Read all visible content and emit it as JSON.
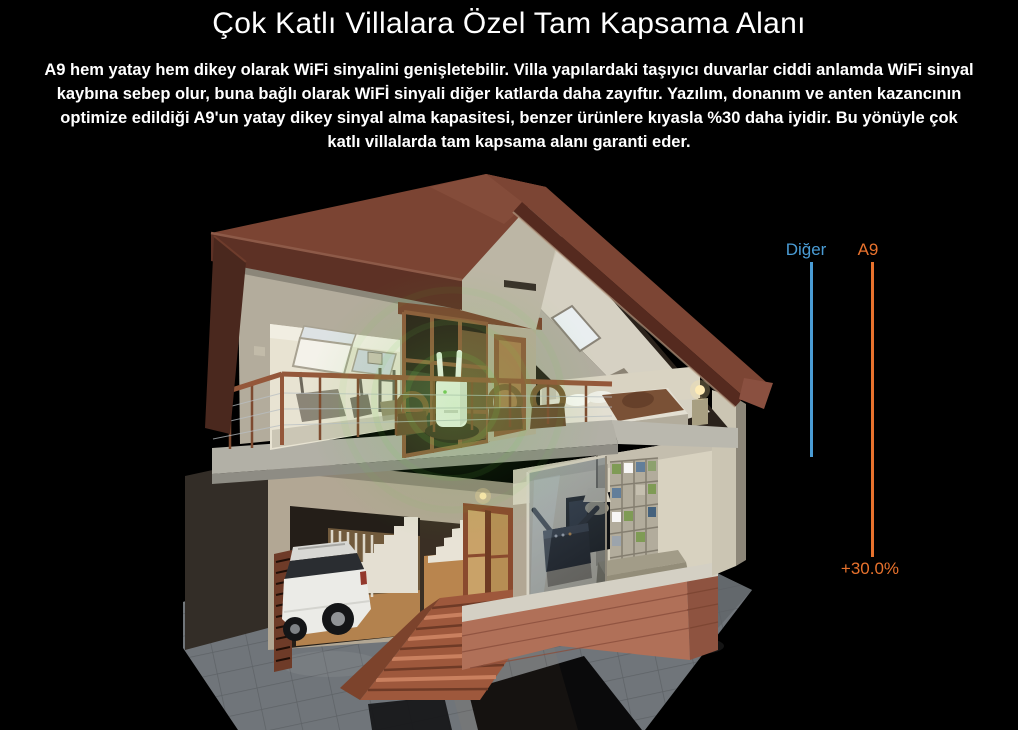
{
  "page": {
    "background_color": "#000000",
    "text_color": "#ffffff",
    "title": "Çok Katlı Villalara Özel Tam Kapsama Alanı",
    "description": "A9 hem yatay hem dikey olarak WiFi sinyalini genişletebilir. Villa yapılardaki taşıyıcı duvarlar ciddi anlamda WiFi sinyal kaybına sebep olur, buna bağlı olarak WiFİ sinyali diğer katlarda daha zayıftır. Yazılım, donanım ve anten kazancının optimize edildiği A9'un yatay dikey sinyal alma kapasitesi, benzer ürünlere kıyasla %30 daha iyidir. Bu yönüyle çok katlı villalarda tam kapsama alanı garanti eder."
  },
  "illustration": {
    "name": "villa-cutaway-3d-render"
  },
  "chart_data": {
    "type": "bar",
    "legend_position": "top",
    "series": [
      {
        "label": "Diğer",
        "color": "#4A9CD5",
        "length_px": 195
      },
      {
        "label": "A9",
        "color": "#E8722D",
        "length_px": 295
      }
    ],
    "annotation": {
      "text": "+30.0%",
      "color": "#E8722D"
    }
  }
}
